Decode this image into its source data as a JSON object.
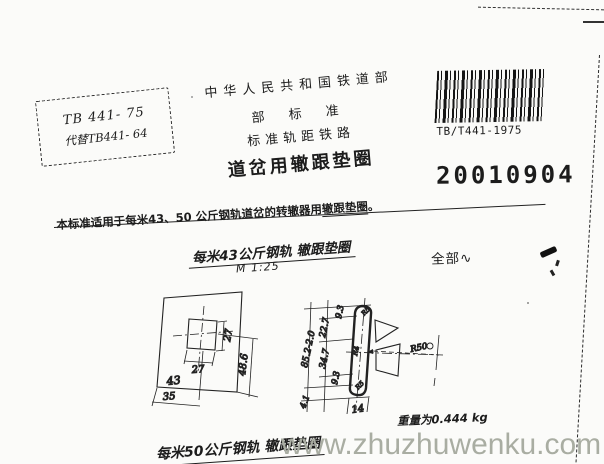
{
  "colors": {
    "paper": "#fbfbf9",
    "ink": "#1c1c1c",
    "watermark_gray": "#a9ada2"
  },
  "stamp": {
    "code": "TB 441- 75",
    "replaces": "代替TB441- 64"
  },
  "header": {
    "authority": "中华人民共和国铁道部",
    "standard_type": "部 标 准",
    "railway": "标准轨距铁路",
    "title": "道岔用辙跟垫圈"
  },
  "barcode": {
    "label": "TB/T441-1975"
  },
  "doc_number": "20010904",
  "scope": {
    "prefix": "本标准适用于每米43、50 公斤钢轨道岔的转辙器用",
    "emph": "辙跟垫圈",
    "period": "。"
  },
  "figure_43": {
    "title": "每米43公斤钢轨 辙跟垫圈",
    "scale": "M 1:25",
    "surface_all": "全部",
    "surface_symbol": "∿",
    "weight": "重量为0.444 kg",
    "plan_dims": {
      "hole_width": "27",
      "hole_height": "27",
      "width": "43",
      "offset": "35",
      "height": "48.6"
    },
    "section_dims": {
      "overall": "85.2-2.0",
      "seg_top": "9.3",
      "seg_upper": "22.7",
      "seg_mid": "34.7",
      "seg_lower": "9.3",
      "seg_bottom": "4.1",
      "thickness": "14",
      "radius_leader": "R50",
      "fillet_top": "R5",
      "fillet_mid": "R4",
      "fillet_bottom": "R5"
    }
  },
  "figure_50": {
    "title": "每米50公斤钢轨 辙跟垫圈"
  },
  "watermark": "www.zhuzhuwenku.com"
}
